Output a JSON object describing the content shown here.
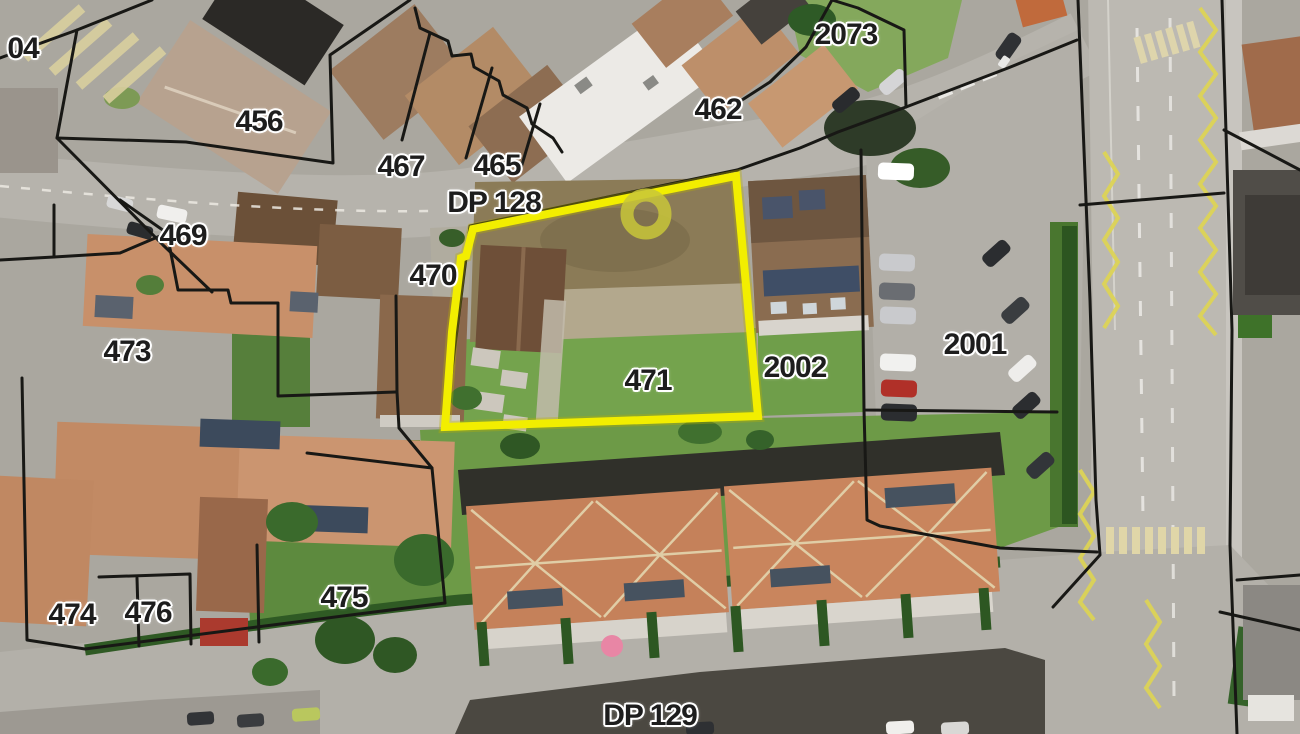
{
  "map": {
    "description": "Aerial cadastral map with parcel boundaries and a highlighted parcel",
    "selected_parcel": {
      "id": "471",
      "highlight_color": "#f2ee00",
      "marker_color": "#c8c53a",
      "marker_shape": "ring"
    },
    "style": {
      "boundary_color": "#181815",
      "label_color": "#1d1d1d",
      "label_halo_color": "#ffffff",
      "road_color": "#b5b2ab",
      "lawn_color": "#6d9a47",
      "zigzag_color": "#dcd356",
      "crosswalk_color": "#e0d6a8"
    },
    "labels": [
      {
        "id": "parcel-04",
        "text": "04",
        "x": 23,
        "y": 49
      },
      {
        "id": "parcel-456",
        "text": "456",
        "x": 259,
        "y": 122
      },
      {
        "id": "parcel-467",
        "text": "467",
        "x": 401,
        "y": 167
      },
      {
        "id": "parcel-465",
        "text": "465",
        "x": 497,
        "y": 166
      },
      {
        "id": "road-dp-128",
        "text": "DP 128",
        "x": 494,
        "y": 203
      },
      {
        "id": "parcel-462",
        "text": "462",
        "x": 718,
        "y": 110
      },
      {
        "id": "parcel-2073",
        "text": "2073",
        "x": 846,
        "y": 35
      },
      {
        "id": "parcel-469",
        "text": "469",
        "x": 183,
        "y": 236
      },
      {
        "id": "parcel-470",
        "text": "470",
        "x": 433,
        "y": 276
      },
      {
        "id": "parcel-473",
        "text": "127-label",
        "x": 127,
        "y": 352
      },
      {
        "id": "parcel-471",
        "text": "471",
        "x": 648,
        "y": 381
      },
      {
        "id": "parcel-2002",
        "text": "2002",
        "x": 795,
        "y": 368
      },
      {
        "id": "parcel-2001",
        "text": "2001",
        "x": 975,
        "y": 345
      },
      {
        "id": "parcel-474",
        "text": "474",
        "x": 72,
        "y": 615
      },
      {
        "id": "parcel-476",
        "text": "476",
        "x": 148,
        "y": 613
      },
      {
        "id": "parcel-475",
        "text": "475",
        "x": 344,
        "y": 598
      },
      {
        "id": "road-dp-129",
        "text": "DP 129",
        "x": 650,
        "y": 716
      }
    ]
  }
}
